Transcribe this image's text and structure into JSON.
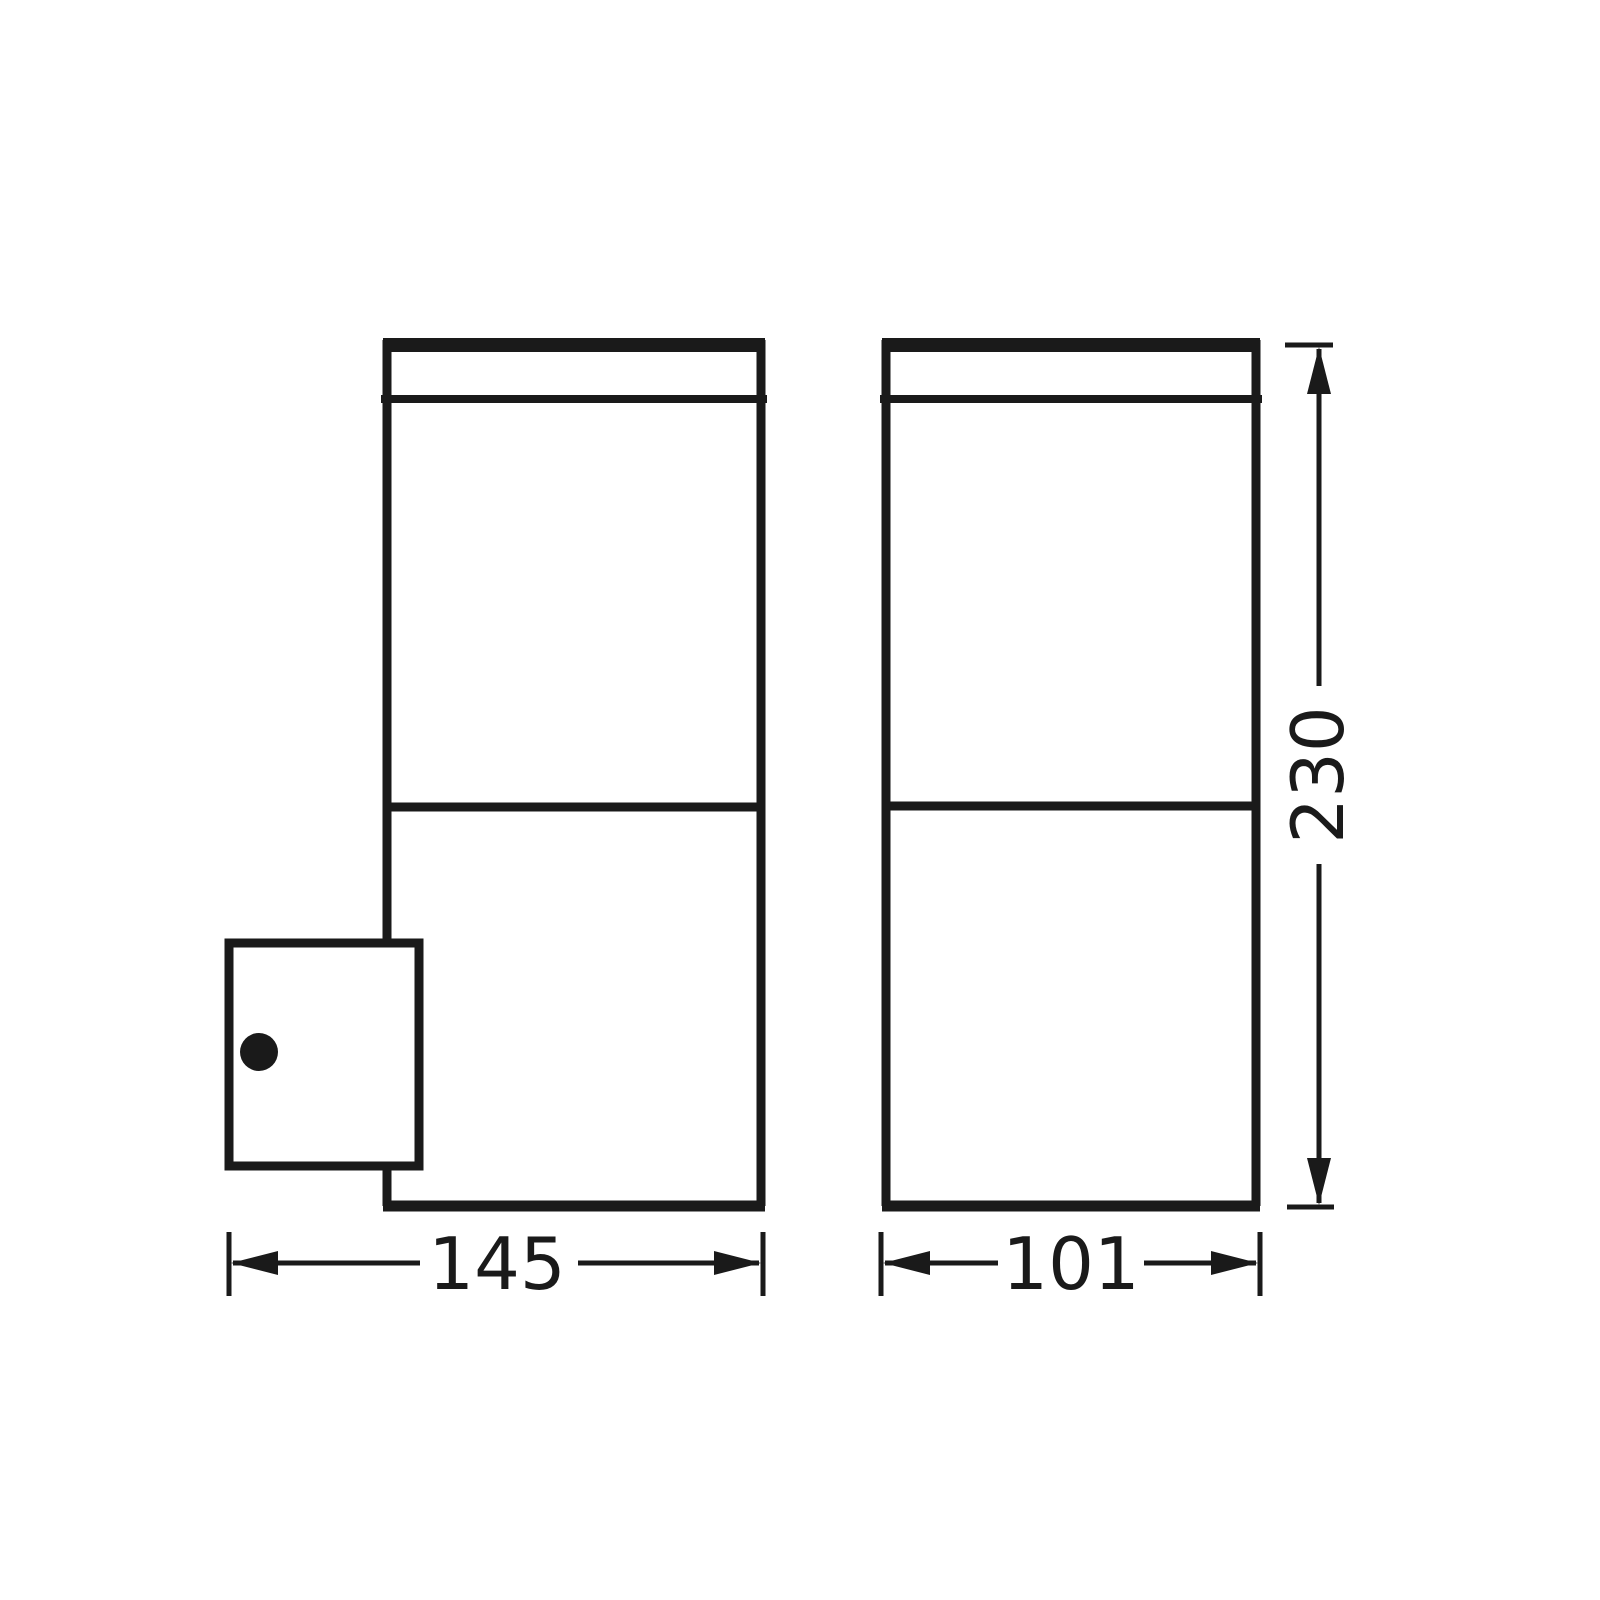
{
  "diagram": {
    "type": "technical-dimension-drawing",
    "subject": "outdoor wall luminaire, side and front elevations with millimetre dimensions",
    "colors": {
      "line": "#1a1a1a",
      "background": "#ffffff"
    },
    "views": [
      {
        "id": "side-view",
        "description": "side elevation with wall-mount bracket and screw hole"
      },
      {
        "id": "front-view",
        "description": "front elevation"
      }
    ],
    "dimensions": [
      {
        "id": "width-side",
        "label": "145",
        "orientation": "horizontal"
      },
      {
        "id": "width-front",
        "label": "101",
        "orientation": "horizontal"
      },
      {
        "id": "height",
        "label": "230",
        "orientation": "vertical"
      }
    ]
  }
}
